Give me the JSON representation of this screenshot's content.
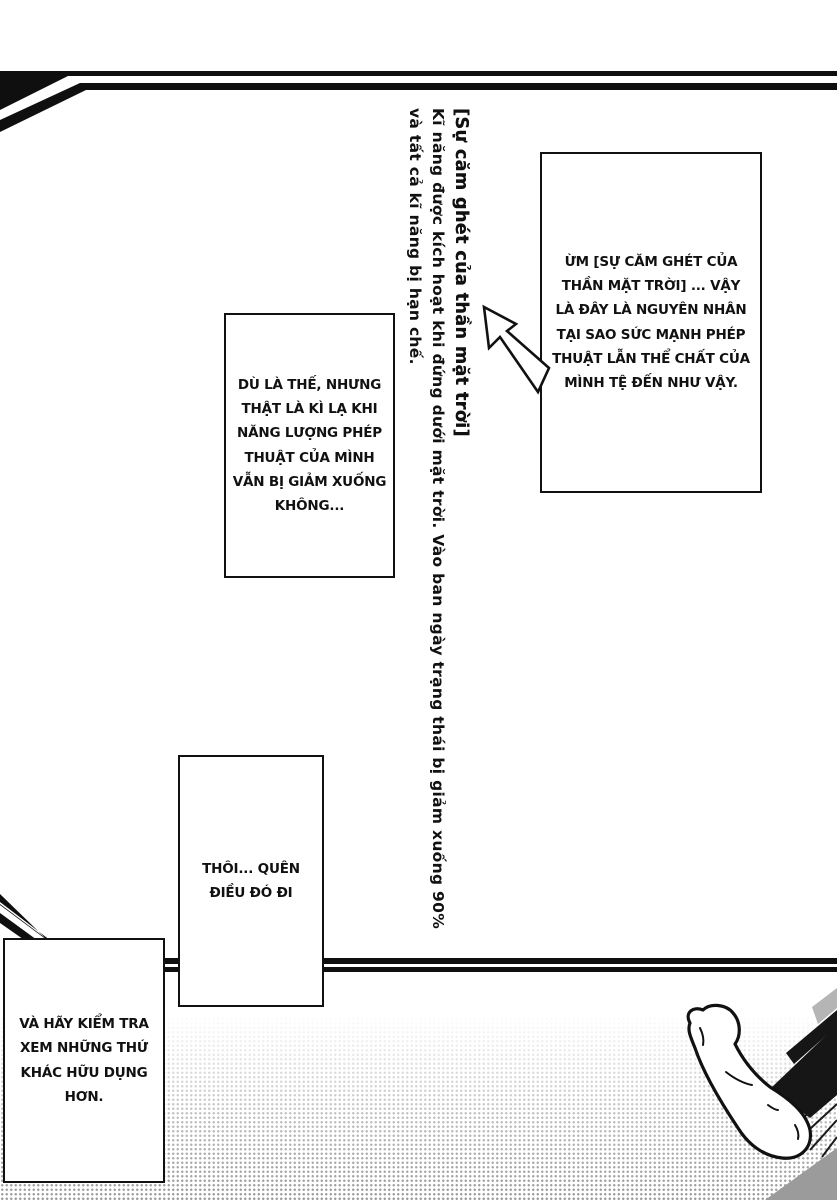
{
  "page": {
    "type": "manga-page",
    "paper_color": "#ffffff",
    "ink_color": "#111111",
    "halftone_color": "#8f8f8f"
  },
  "vertical_note": {
    "title": "[Sự căm ghét của thần mặt trời]",
    "body_line1": "Kĩ năng được kích hoạt khi đứng dưới mặt trời. Vào ban ngày trạng thái bị giảm xuống 90%",
    "body_line2": "và tất cả kĩ năng bị hạn chế."
  },
  "bubbles": {
    "sun_god": {
      "lines": [
        "ỪM [SỰ CĂM GHÉT CỦA",
        "THẦN MẶT TRỜI] ... VẬY",
        "LÀ ĐÂY LÀ NGUYÊN NHÂN",
        "TẠI SAO SỨC MẠNH PHÉP",
        "THUẬT LẪN THỂ CHẤT CỦA",
        "MÌNH TỆ ĐẾN NHƯ VẬY."
      ]
    },
    "strange": {
      "lines": [
        "DÙ LÀ THẾ, NHƯNG",
        "THẬT LÀ KÌ LẠ KHI",
        "NĂNG LƯỢNG PHÉP",
        "THUẬT CỦA MÌNH",
        "VẪN BỊ GIẢM XUỐNG",
        "KHÔNG..."
      ]
    },
    "forget": {
      "lines": [
        "THÔI... QUÊN",
        "ĐIỀU ĐÓ ĐI"
      ]
    },
    "check": {
      "lines": [
        "VÀ HÃY KIỂM TRA",
        "XEM NHỮNG THỨ",
        "KHÁC HỮU DỤNG",
        "HƠN."
      ]
    }
  },
  "art": {
    "arrow": "arrow-pointing-up-left-to-skill-note",
    "foot": "bare-foot-with-trouser-leg",
    "borders": "diagonal-speedline-page-borders",
    "floor": "halftone-gradient-floor"
  }
}
